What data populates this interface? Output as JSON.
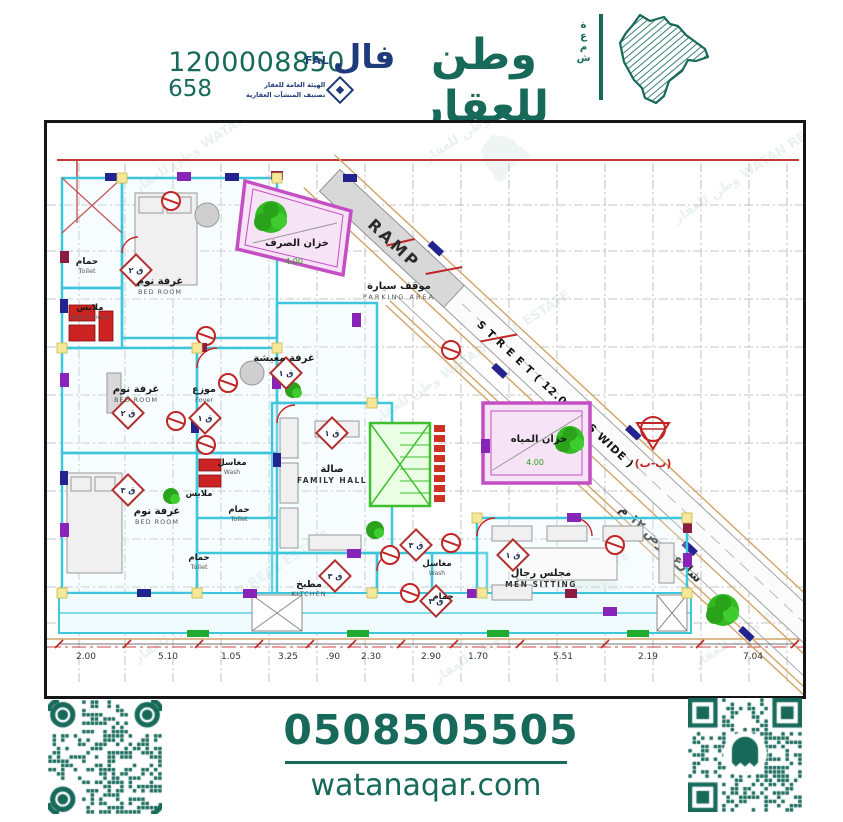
{
  "header": {
    "phone_main": "1200008850",
    "phone_sub": "658",
    "fal_en": "FAL",
    "fal_ar": "فال",
    "authority_line1": "الهيئة العامة للعقار",
    "authority_line2": "تصنيف المنشآت العقارية",
    "brand_ar": "وطن للعقار",
    "brand_en": "WATAN REAL ESTATE",
    "brand_side": "شمعة"
  },
  "watermark": {
    "text": "وطن للعقار WATAN REAL ESTATE"
  },
  "plan": {
    "ramp_label": "RAMP",
    "street_label": "S T R E E T ( 12.00 MTS WIDE )",
    "street_label_ar": "شارع عرض ١٢ م",
    "section_tag": "(ب-ب)",
    "sewage_tank_dim": "4.00",
    "water_tank_dim": "4.00",
    "rooms": [
      {
        "ar": "حمام",
        "en": "Toilet"
      },
      {
        "ar": "غرفة نوم",
        "en": "BED ROOM"
      },
      {
        "ar": "ملابس",
        "en": "Walk in Closet"
      },
      {
        "ar": "خزان الصرف",
        "en": ""
      },
      {
        "ar": "موقف سيارة",
        "en": "PARKING AREA"
      },
      {
        "ar": "غرفة معيشة",
        "en": ""
      },
      {
        "ar": "غرفة نوم",
        "en": "BED ROOM"
      },
      {
        "ar": "موزع",
        "en": "Foyer"
      },
      {
        "ar": "صالة",
        "en": "FAMILY HALL"
      },
      {
        "ar": "خزان المياه",
        "en": ""
      },
      {
        "ar": "غرفة نوم",
        "en": "BED ROOM"
      },
      {
        "ar": "ملابس",
        "en": ""
      },
      {
        "ar": "حمام",
        "en": "Toilet"
      },
      {
        "ar": "حمام",
        "en": "Toilet"
      },
      {
        "ar": "مغاسل",
        "en": "Wash"
      },
      {
        "ar": "مطبخ",
        "en": "KITCHEN"
      },
      {
        "ar": "مغاسل",
        "en": "Wash"
      },
      {
        "ar": "حمام",
        "en": ""
      },
      {
        "ar": "مجلس رجال",
        "en": "MEN SITTING"
      }
    ],
    "door_tags": [
      "ق ٢",
      "ق ١",
      "ق ١",
      "ق ٢",
      "ق ١",
      "ق ٣",
      "ق ٣",
      "ق ٣",
      "ق ٣",
      "ق ١"
    ],
    "dimensions": [
      "2.00",
      "5.10",
      "1.05",
      "3.25",
      ".90",
      "2.30",
      "2.90",
      "1.70",
      "5.51",
      "2.19",
      "7.04"
    ]
  },
  "footer": {
    "whatsapp_number": "0508505505",
    "website": "watanaqar.com",
    "qr_left_icon": "qr-code",
    "qr_right_icon": "snapchat-ghost-qr",
    "whatsapp_icon": "whatsapp-icon"
  },
  "colors": {
    "teal": "#17695a",
    "navy": "#1f3a7a",
    "wall_cyan": "#3ec7dc",
    "tank_magenta": "#c44fc4",
    "tree_green": "#2fb32a",
    "symbol_red": "#c12525",
    "street_tan": "#d2a469"
  }
}
